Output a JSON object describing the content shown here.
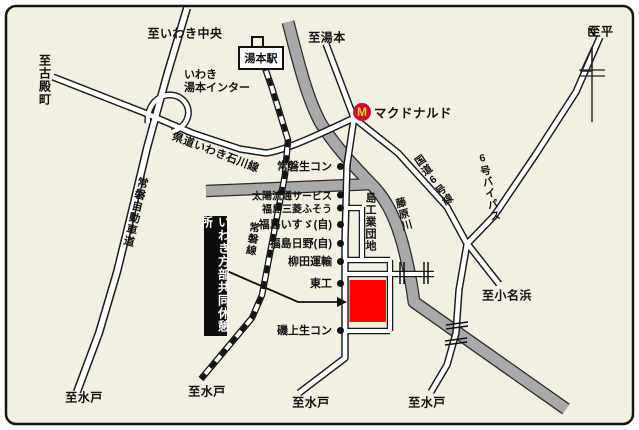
{
  "colors": {
    "background": "#f3efe2",
    "road_fill": "#ffffff",
    "river_gray": "#a9a9a9",
    "destination_red": "#ff0000",
    "mcdonalds_red": "#c8102e",
    "mcdonalds_yellow": "#ffc72c"
  },
  "compass": {
    "north": "N"
  },
  "directions": {
    "iwaki_chuo": "至いわき中央",
    "kodonomachi": "至古殿町",
    "yumoto": "至湯本",
    "taira": "至平",
    "onahama": "至小名浜",
    "mito": "至水戸"
  },
  "roads": {
    "joban_expressway": "常磐自動車道",
    "pref_iwaki_ishikawa_line": "県道いわき石川線",
    "route6": "国道6号線",
    "route6_bypass": "6号バイパス"
  },
  "railway": {
    "joban_line": "常磐線",
    "yumoto_station": "湯本駅"
  },
  "river": {
    "fujiwara": "藤原川"
  },
  "interchange": {
    "line1": "いわき",
    "line2": "湯本インター"
  },
  "mcdonalds": {
    "initial": "M",
    "label": "マクドナルド"
  },
  "industrial_park": "島工業団地",
  "pois": [
    {
      "label": "常磐生コン"
    },
    {
      "label": "太陽流通サービス"
    },
    {
      "label": "福島三菱ふそう"
    },
    {
      "label": "福島いすゞ(自)"
    },
    {
      "label": "福島日野(自)"
    },
    {
      "label": "柳田運輸"
    },
    {
      "label": "東工"
    },
    {
      "label": "磯上生コン"
    }
  ],
  "destination": {
    "name": "いわき方部共同休憩所"
  }
}
